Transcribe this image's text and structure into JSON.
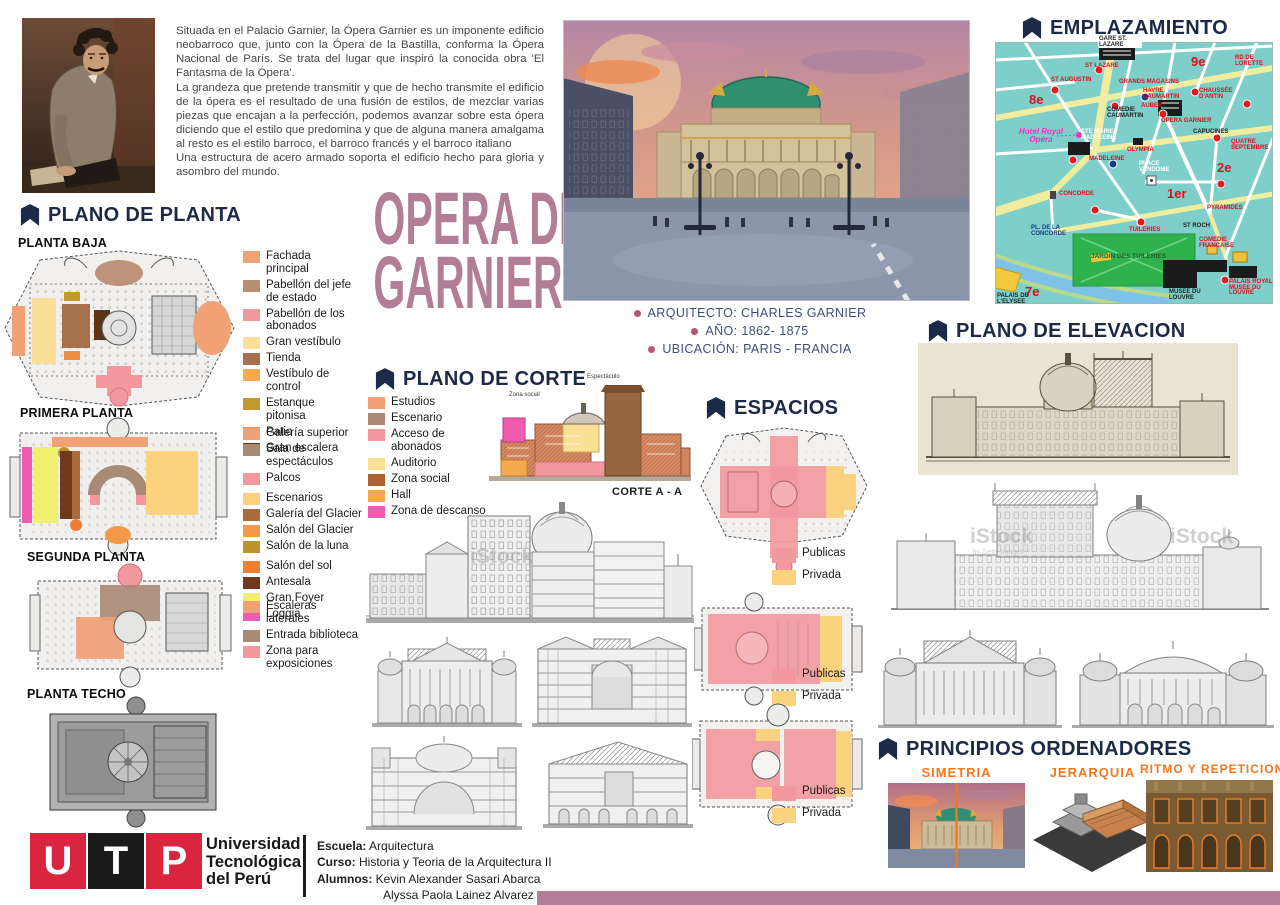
{
  "poster": {
    "title_line1": "OPERA DE",
    "title_line2": "GARNIER",
    "title_color": "#b27e95",
    "heading_color": "#1c2947",
    "bottom_bar_color": "#b17e95",
    "principle_label_color": "#f4771f"
  },
  "intro": {
    "p1": "Situada en el Palacio Garnier, la Ópera Garnier es un imponente edificio neobarroco que, junto con la Ópera de la Bastilla, conforma la Ópera Nacional de París. Se trata del lugar que inspiró la conocida obra 'El Fantasma de la Ópera'.",
    "p2": "La grandeza que pretende transmitir y que de hecho transmite el edificio de la ópera es el resultado de una fusión de estilos, de mezclar varias piezas que encajan a la perfección, podemos avanzar sobre esta ópera diciendo que el estilo que predomina y que de alguna manera amalgama al resto es el estilo barroco, el barroco francés y el barroco italiano",
    "p3": "Una estructura de acero armado soporta el edificio hecho para gloria y asombro del mundo."
  },
  "headings": {
    "plano_planta": "PLANO DE PLANTA",
    "emplazamiento": "EMPLAZAMIENTO",
    "plano_corte": "PLANO DE CORTE",
    "espacios": "ESPACIOS",
    "plano_elevacion": "PLANO DE ELEVACION",
    "principios": "PRINCIPIOS ORDENADORES"
  },
  "facts": {
    "architect": "ARQUITECTO: CHARLES GARNIER",
    "year": "AÑO: 1862- 1875",
    "location": "UBICACIÓN: PARIS - FRANCIA"
  },
  "planta_baja": {
    "label": "PLANTA BAJA",
    "legend": [
      {
        "color": "#f0a175",
        "label": "Fachada principal"
      },
      {
        "color": "#b98e72",
        "label": "Pabellón del jefe de estado"
      },
      {
        "color": "#f2989e",
        "label": "Pabellón de los abonados"
      },
      {
        "color": "#fbdf96",
        "label": "Gran vestíbulo"
      },
      {
        "color": "#a8714d",
        "label": "Tienda"
      },
      {
        "color": "#f6a94e",
        "label": "Vestíbulo de control"
      },
      {
        "color": "#c39a2f",
        "label": "Estanque pitonisa"
      },
      {
        "color": "#ee8c40",
        "label": "Patio"
      },
      {
        "color": "#5f3317",
        "label": "Gran escalera"
      }
    ]
  },
  "primera_planta": {
    "label": "PRIMERA PLANTA",
    "legend": [
      {
        "color": "#f0a175",
        "label": "Galería superior"
      },
      {
        "color": "#a98a74",
        "label": "Sala de espectáculos"
      },
      {
        "color": "#f2989e",
        "label": "Palcos"
      },
      {
        "color": "#fbd37e",
        "label": "Escenarios"
      },
      {
        "color": "#aa6a3b",
        "label": "Galería del Glacier"
      },
      {
        "color": "#f29a49",
        "label": "Salón del Glacier"
      },
      {
        "color": "#bd9427",
        "label": "Salón de la luna"
      },
      {
        "color": "#ec7f34",
        "label": "Salón del sol"
      },
      {
        "color": "#6e3a1b",
        "label": "Antesala"
      },
      {
        "color": "#eef06e",
        "label": "Gran Foyer"
      },
      {
        "color": "#f05cb2",
        "label": "Loggia"
      }
    ]
  },
  "segunda_planta": {
    "label": "SEGUNDA PLANTA",
    "legend": [
      {
        "color": "#f0a175",
        "label": "Escaleras laterales"
      },
      {
        "color": "#a98a74",
        "label": "Entrada biblioteca"
      },
      {
        "color": "#f2989e",
        "label": "Zona para exposiciones"
      }
    ]
  },
  "planta_techo": {
    "label": "PLANTA TECHO"
  },
  "corte": {
    "caption": "CORTE A - A",
    "img_label_top": "Espectáculo",
    "img_label_left": "Zona social",
    "legend": [
      {
        "color": "#f0a175",
        "label": "Estudios"
      },
      {
        "color": "#a98a74",
        "label": "Escenario"
      },
      {
        "color": "#f2989e",
        "label": "Acceso de abonados"
      },
      {
        "color": "#fbdf96",
        "label": "Auditorio"
      },
      {
        "color": "#a8622e",
        "label": "Zona social"
      },
      {
        "color": "#f6a94e",
        "label": "Hall"
      },
      {
        "color": "#f05cb2",
        "label": "Zona de descanso"
      }
    ]
  },
  "espacios": {
    "publicas": "Publicas",
    "privada": "Privada",
    "color_publicas": "#f2989e",
    "color_privada": "#fbd37e"
  },
  "principios": {
    "simetria": "SIMETRIA",
    "jerarquia": "JERARQUIA",
    "ritmo": "RITMO Y REPETICION"
  },
  "map": {
    "labels": [
      "GARE ST. LAZARE",
      "ST LAZARE",
      "ST AUGUSTIN",
      "RD DE LORETTE",
      "GRANDS MAGASINS",
      "HAVRE CAUMARTIN",
      "CHAUSSÉE D'ANTIN",
      "AUBER",
      "COMEDIE CAUMARTIN",
      "OPERA GARNIER",
      "Hotel Royal Opéra",
      "STE MARIE MADELEINE",
      "MADELEINE",
      "OLYMPIA",
      "CAPUCINES",
      "QUATRE SEPTEMBRE",
      "PLACE VENDOME",
      "CONCORDE",
      "PL. DE LA CONCORDE",
      "JARDIN DES TUILERIES",
      "ST ROCH",
      "TUILERIES",
      "PYRAMIDES",
      "COMEDIE FRANCAISE",
      "PALAIS ROYAL MUSEE DU LOUVRE",
      "MUSEE DU LOUVRE",
      "8e",
      "9e",
      "1er",
      "2e",
      "7e",
      "PALAIS DE L'ELYSEE"
    ]
  },
  "watermark": {
    "main": "iStock",
    "sub": "by Getty Images™"
  },
  "footer": {
    "logo_letters": [
      "U",
      "T",
      "P"
    ],
    "logo_red": "#d9253f",
    "logo_black": "#1b1b1b",
    "uni_line1": "Universidad",
    "uni_line2": "Tecnológica",
    "uni_line3": "del Perú",
    "school_label": "Escuela:",
    "school_value": " Arquitectura",
    "course_label": "Curso:",
    "course_value": " Historia y Teoria de la Arquitectura II",
    "students_label": "Alumnos:",
    "student1": " Kevin Alexander Sasari Abarca",
    "student2": "Alyssa Paola Lainez Alvarez"
  }
}
